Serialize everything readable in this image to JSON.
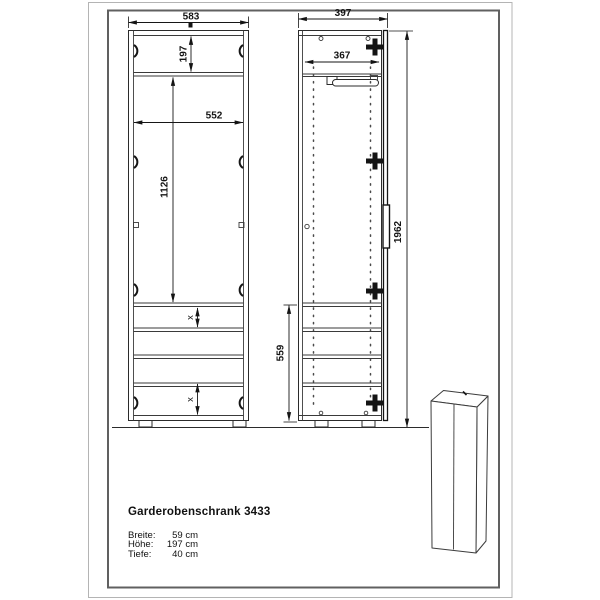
{
  "frame": {
    "outer_color": "#b4b4b4",
    "inner_color": "#606060"
  },
  "drawing": {
    "ink_color": "#1a1a1a",
    "front_view": {
      "width": "583",
      "top_section_height": "197",
      "interior_width": "552",
      "middle_section_height": "1126",
      "shelf_spacing_upper": "x",
      "shelf_spacing_lower": "x"
    },
    "side_view": {
      "depth": "397",
      "interior_depth": "367",
      "lower_section_height": "559",
      "total_height": "1962"
    }
  },
  "product": {
    "title": "Garderobenschrank 3433",
    "specs": [
      {
        "label": "Breite:",
        "value": "59 cm"
      },
      {
        "label": "Höhe:",
        "value": "197 cm"
      },
      {
        "label": "Tiefe:",
        "value": "40 cm"
      }
    ]
  }
}
